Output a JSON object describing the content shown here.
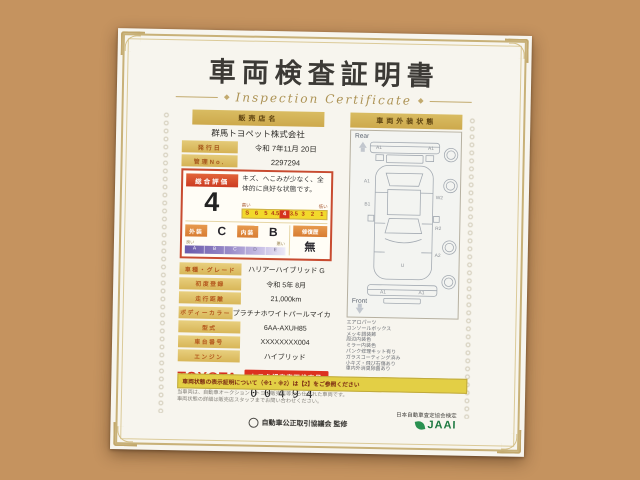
{
  "certificate": {
    "title": "車両検査証明書",
    "subtitle": "Inspection Certificate",
    "dealer": {
      "label": "販売店名",
      "value": "群馬トヨペット株式会社"
    },
    "issue_date": {
      "label": "発行日",
      "value": "令和 7年11月 20日"
    },
    "control_no": {
      "label": "管理No.",
      "value": "2297294"
    },
    "evaluation": {
      "label": "総合評価",
      "score": "4",
      "comment": "キズ、へこみが少なく、全体的に良好な状態です。",
      "scale_high_label": "高い",
      "scale_low_label": "低い",
      "scale_cells": [
        "S",
        "6",
        "5",
        "4.5",
        "4",
        "3.5",
        "3",
        "2",
        "1"
      ],
      "scale_selected": "4",
      "exterior_label": "外装",
      "exterior_value": "C",
      "interior_label": "内装",
      "interior_value": "B",
      "repair_label": "修復歴",
      "repair_value": "無",
      "grade_good_label": "良い",
      "grade_bad_label": "悪い",
      "grade_cells": [
        "A",
        "B",
        "C",
        "D",
        "E"
      ]
    },
    "specs": [
      {
        "label": "車種・グレード",
        "value": "ハリアーハイブリッド G"
      },
      {
        "label": "初度登録",
        "value": "令和 5年 8月"
      },
      {
        "label": "走行距離",
        "value": "21,000km"
      },
      {
        "label": "ボディーカラー",
        "value": "プラチナホワイトパールマイカ"
      },
      {
        "label": "型式",
        "value": "6AA-AXUH85"
      },
      {
        "label": "車台番号",
        "value": "XXXXXXXX004"
      },
      {
        "label": "エンジン",
        "value": "ハイブリッド"
      }
    ],
    "inspector": {
      "brand": "TOYOTA",
      "badge": "トヨタ認定車両検査員",
      "number": "00494"
    },
    "notice_bar": "車両状態の表示証明について（※1・※2）は【2】をご参照ください",
    "fine_print": [
      "当車両は、自動車オークション・トヨタ販売店等から仕入れた車両です。",
      "車両状態の詳細は販売店スタッフまでお問い合わせください。"
    ],
    "footer": {
      "left": "自動車公正取引協議会 監修",
      "right": "日本自動車査定協会検定",
      "right_logo": "JAAI"
    },
    "exterior_panel": {
      "header": "車両外装状態",
      "rear_label": "Rear",
      "front_label": "Front",
      "marks": {
        "rear_left": "A1",
        "rear_right": "A1",
        "side_left_1": "A1",
        "side_left_2": "B1",
        "side_right_1": "W2",
        "side_right_2": "R2",
        "side_right_3": "A2",
        "center": "U",
        "front_left": "A1",
        "front_right": "A1"
      },
      "equipment_list": [
        "エアロパーツ",
        "コンソールボックス",
        "メッキ調装飾",
        "周辺内装色",
        "ミラー内装色",
        "パンク修理キット有り",
        "ガラスコーティング済み",
        "小キズ・飛び石傷あり",
        "車内外消臭除菌あり"
      ]
    }
  }
}
